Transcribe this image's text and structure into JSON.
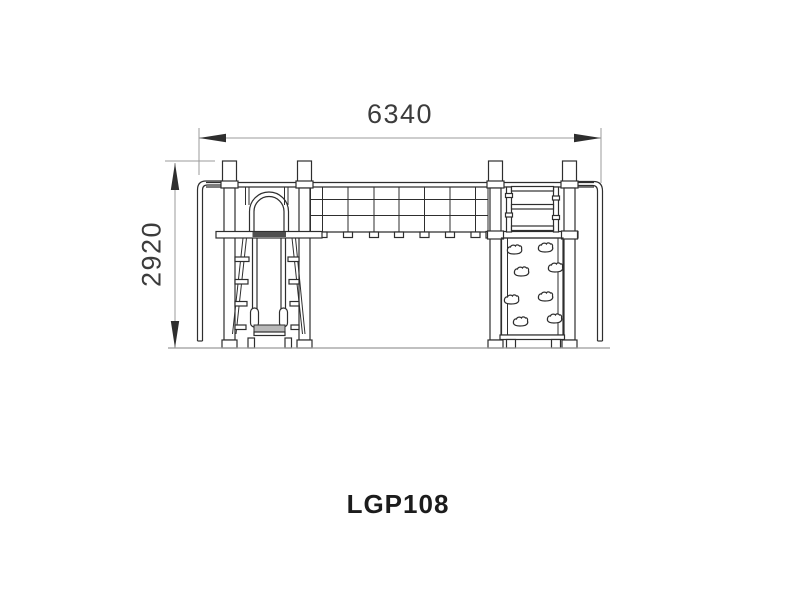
{
  "drawing": {
    "product_code": "LGP108",
    "dim_width": "6340",
    "dim_height": "2920"
  },
  "colors": {
    "background": "#ffffff",
    "line": "#2e2e2e",
    "dimension_line": "#9b9b9b",
    "dimension_text": "#3c3c3c",
    "label_text": "#1c1c1c",
    "slide_exit_shade": "#b9b9b9",
    "slide_top_shade": "#4f4f4f",
    "ground_line": "#9b9b9b"
  },
  "parts": {
    "left_tower": "slide-tower",
    "bridge": "climbing-net-bridge",
    "right_tower": "climbing-tower",
    "wall": "climbing-wall-with-holds",
    "slide": "straight-slide-front-view"
  }
}
